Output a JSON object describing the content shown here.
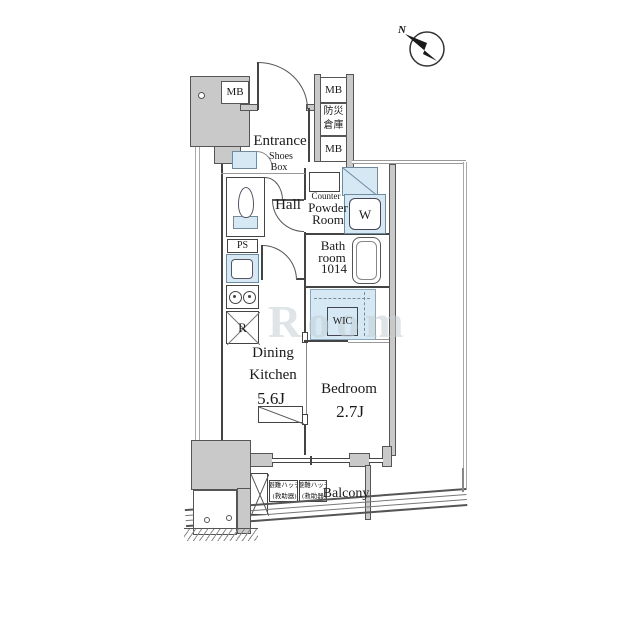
{
  "compass": {
    "north_label": "N"
  },
  "watermark": "Room",
  "meter_boxes": {
    "top_left": "MB",
    "right_top": "MB",
    "right_bottom": "MB",
    "disaster_storage_line1": "防災",
    "disaster_storage_line2": "倉庫"
  },
  "rooms": {
    "entrance": "Entrance",
    "shoes_box_line1": "Shoes",
    "shoes_box_line2": "Box",
    "hall": "Hall",
    "counter": "Counter",
    "powder_line1": "Powder",
    "powder_line2": "Room",
    "washer": "W",
    "bath_line1": "Bath",
    "bath_line2": "room",
    "bath_line3": "1014",
    "pipe_space": "PS",
    "refrigerator": "R",
    "wic": "WIC",
    "dk_line1": "Dining",
    "dk_line2": "Kitchen",
    "dk_size": "5.6J",
    "bedroom": "Bedroom",
    "bedroom_size": "2.7J",
    "balcony": "Balcony",
    "hatch1_line1": "避難ハッチ",
    "hatch1_line2": "(救助器)",
    "hatch2_line1": "避難ハッチ",
    "hatch2_line2": "(救助器)"
  },
  "colors": {
    "wall_gray": "#c9c9c9",
    "fixture_blue": "#d5e8f4",
    "line": "#444444",
    "watermark_gray": "#c4cdd4"
  }
}
